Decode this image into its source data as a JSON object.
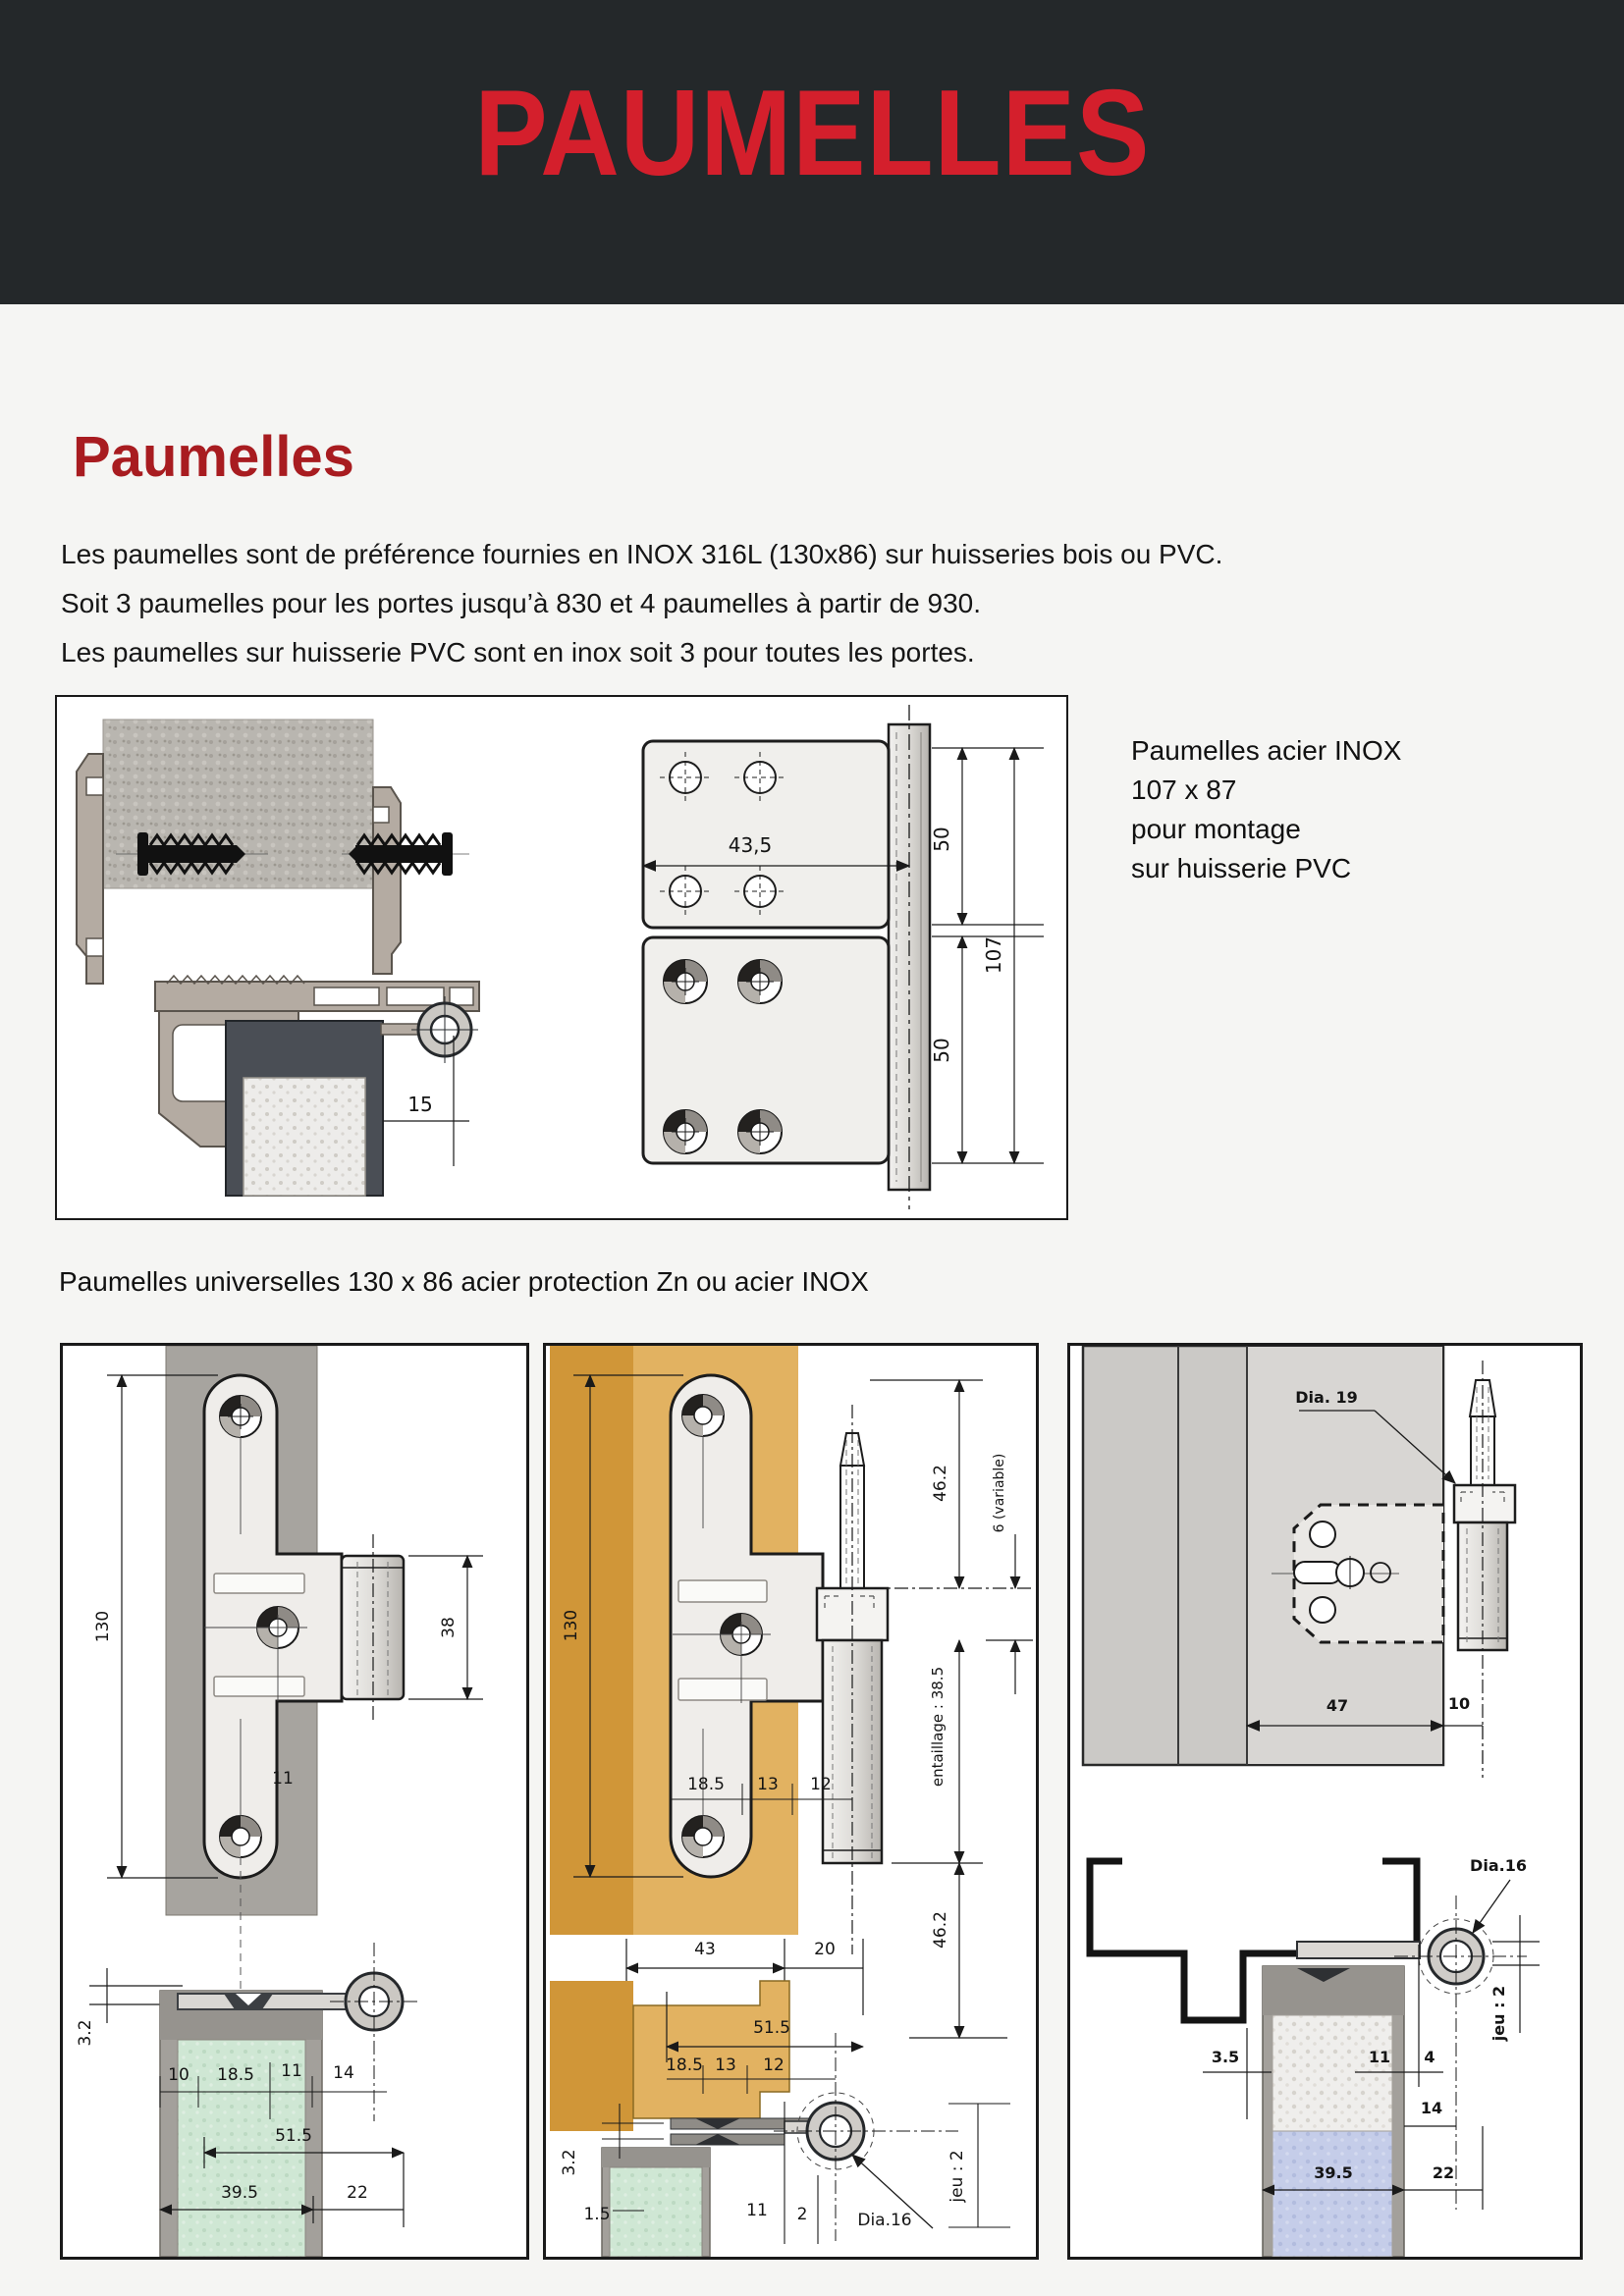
{
  "header": {
    "title": "PAUMELLES"
  },
  "section": {
    "heading": "Paumelles"
  },
  "intro": {
    "lines": [
      "Les paumelles sont de préférence fournies en INOX 316L (130x86) sur huisseries bois ou PVC.",
      "Soit 3 paumelles pour les portes jusqu’à 830 et 4 paumelles à partir de 930.",
      "Les paumelles sur huisserie PVC sont en inox soit 3 pour toutes les portes."
    ]
  },
  "side_note": {
    "lines": [
      "Paumelles acier INOX",
      "107 x 87",
      "pour montage",
      "sur huisserie PVC"
    ]
  },
  "universal_caption": "Paumelles universelles 130 x 86  acier protection Zn ou acier INOX",
  "pvc_box": {
    "dims": {
      "plate_width": "43,5",
      "pitch_top": "50",
      "total_height": "107",
      "pitch_bottom": "50",
      "offset": "15"
    }
  },
  "box_steel": {
    "dims": {
      "height": "130",
      "knuckle": "38",
      "plate": "11",
      "leaf": "3.2",
      "d10": "10",
      "d18_5": "18.5",
      "d11": "11",
      "d14": "14",
      "d51_5": "51.5",
      "d39_5": "39.5",
      "d22": "22"
    }
  },
  "box_wood": {
    "dims": {
      "height": "130",
      "top": "46.2",
      "variable": "6 (variable)",
      "notch": "entaillage : 38.5",
      "bottom": "46.2",
      "r1a": "18.5",
      "r1b": "13",
      "r1c": "12",
      "d43": "43",
      "d20": "20",
      "d51_5": "51.5",
      "r2a": "18.5",
      "r2b": "13",
      "r2c": "12",
      "leaf": "3.2",
      "d1_5": "1.5",
      "d11": "11",
      "d2": "2",
      "dia16": "Dia.16",
      "jeu": "jeu : 2"
    }
  },
  "box_metal": {
    "dims": {
      "dia19": "Dia. 19",
      "d47": "47",
      "d10": "10",
      "dia16": "Dia.16",
      "d3_5": "3.5",
      "d11": "11",
      "d4": "4",
      "d14": "14",
      "d39_5": "39.5",
      "d22": "22",
      "jeu": "jeu : 2"
    }
  },
  "colors": {
    "header_bg": "#24282a",
    "title_red": "#d41f2c",
    "heading_red": "#a81c20",
    "tan_dark": "#d09638",
    "tan_light": "#e2b261",
    "frame_gray": "#a7a49f",
    "door_green": "#cfe7d4",
    "door_blue": "#c5cde9",
    "door_dark": "#4a4e55"
  }
}
